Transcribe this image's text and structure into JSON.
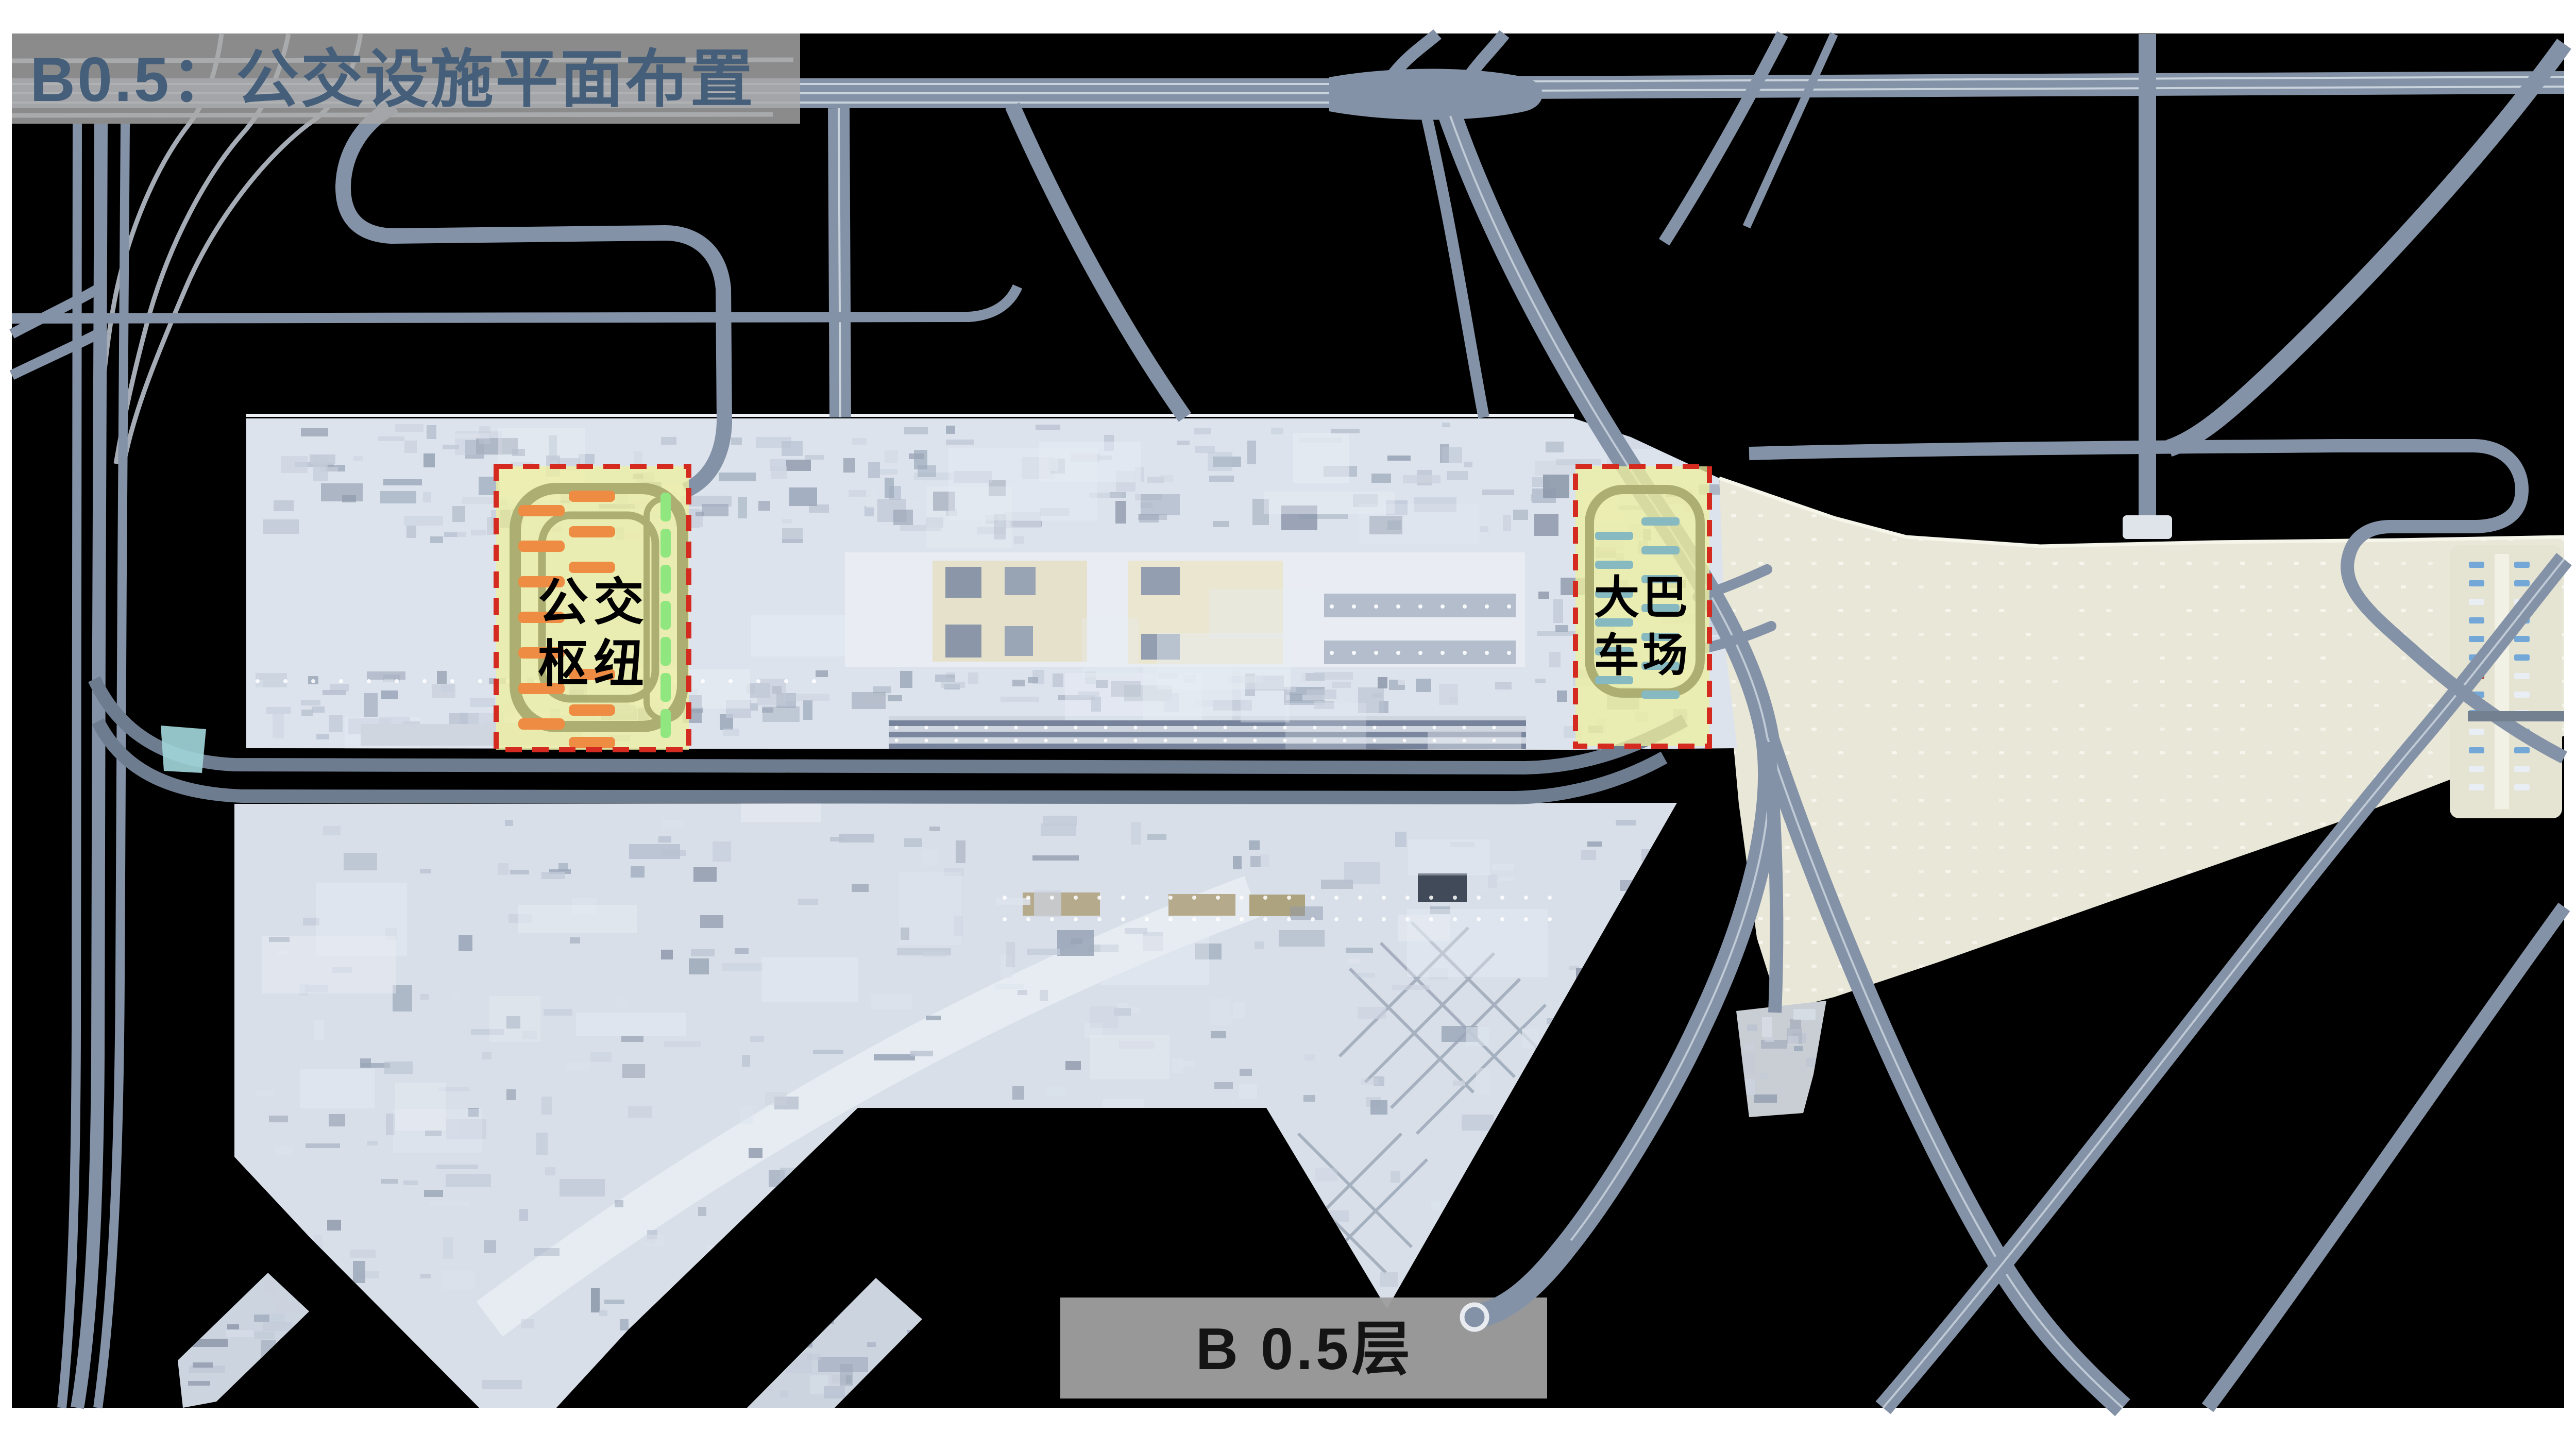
{
  "slide": {
    "title": "B0.5：公交设施平面布置",
    "floor_label": "B 0.5层"
  },
  "zones": [
    {
      "id": "bus-hub",
      "label": "公交枢纽",
      "label_line1": "公交",
      "label_line2": "枢纽",
      "bays": {
        "orange": 13,
        "green": 7
      }
    },
    {
      "id": "coach-yard",
      "label": "大巴车场",
      "label_line1": "大巴",
      "label_line2": "车场",
      "bays": {
        "teal": 13
      }
    }
  ],
  "colors": {
    "page": "#ffffff",
    "canvas": "#000000",
    "road": "#8492a7",
    "road_dark": "#6e7c90",
    "lane_line": "#c9d3dc",
    "building": "#dce3ed",
    "building_light": "#eef1f6",
    "apron": "#e9e7d7",
    "apron_dot": "#f7f6ee",
    "highlight_fill": "#eef0a0",
    "highlight_border": "#d42a20",
    "loop_road": "#a9ac6e",
    "bay_orange": "#ee8c43",
    "bay_green": "#90e67f",
    "bay_teal": "#87b9c1",
    "canopy_teal": "#9fd4d8",
    "banner_gray": "#a9a9a9",
    "title_text": "#455f7b",
    "floor_banner_gray": "#9e9e9e",
    "floor_text": "#141414",
    "car_blue": "#6ba3d8",
    "car_white": "#e8eef5",
    "car_red": "#b03a2e"
  }
}
